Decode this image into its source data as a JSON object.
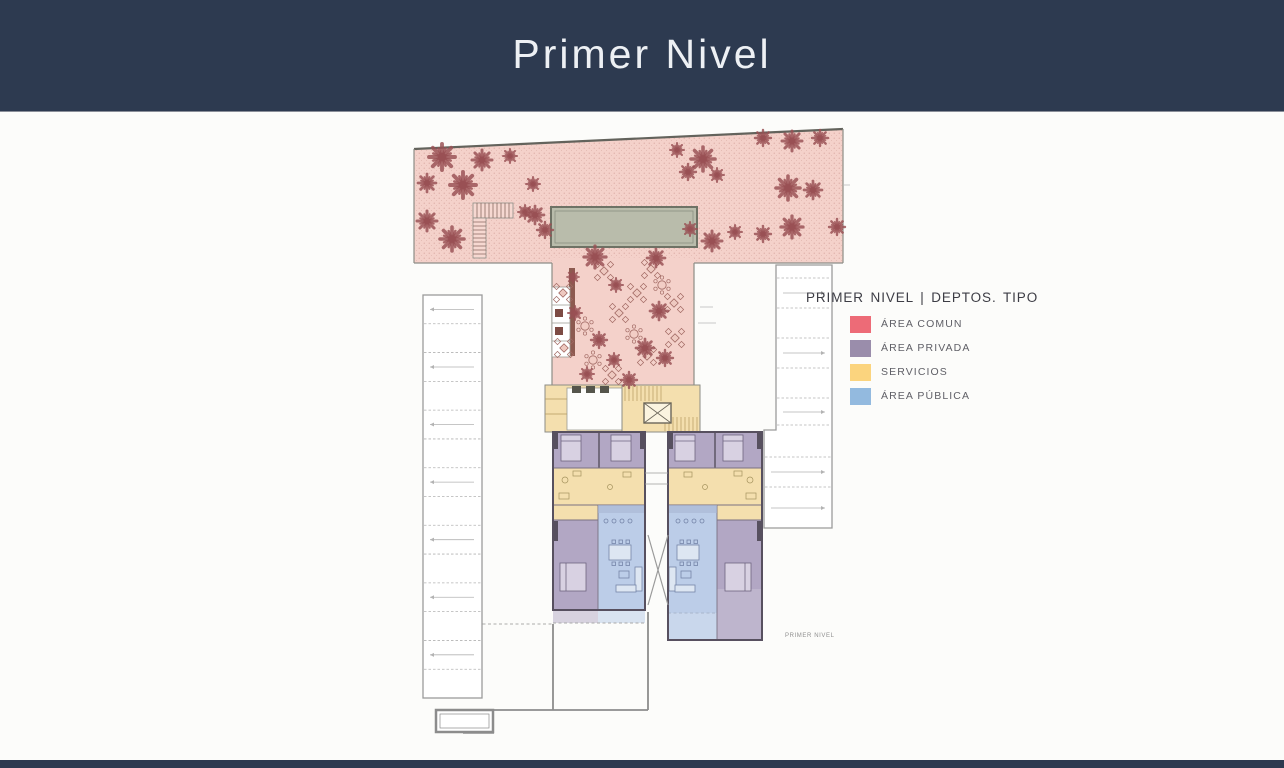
{
  "header": {
    "title": "Primer Nivel"
  },
  "theme": {
    "header_bg": "#2d3a50",
    "title_color": "#edf0f4",
    "slide_bg": "#fcfcfa",
    "footer_bg": "#2d3a50"
  },
  "legend": {
    "title": "PRIMER NIVEL | DEPTOS. TIPO",
    "items": [
      {
        "name": "area-comun",
        "label": "ÁREA COMUN",
        "color": "#ed6b77"
      },
      {
        "name": "area-privada",
        "label": "ÁREA PRIVADA",
        "color": "#9a8dab"
      },
      {
        "name": "servicios",
        "label": "SERVICIOS",
        "color": "#fbd47e"
      },
      {
        "name": "area-publica",
        "label": "ÁREA PÚBLICA",
        "color": "#93badf"
      }
    ]
  },
  "plan": {
    "caption": "PRIMER NIVEL",
    "colors": {
      "garden": "#f4d1ca",
      "pool": "#b9bcab",
      "services": "#f4dfae",
      "private": "#b2a7c4",
      "public": "#bccde8",
      "wall": "#57505f",
      "tree": "#995054",
      "table": "#a26a64",
      "parking_line": "#b3b3b3",
      "parking_border": "#9b9b9b"
    },
    "garden_trees": [
      [
        29,
        30,
        13
      ],
      [
        69,
        33,
        10
      ],
      [
        97,
        29,
        7
      ],
      [
        14,
        56,
        9
      ],
      [
        50,
        58,
        13
      ],
      [
        14,
        94,
        10
      ],
      [
        39,
        112,
        12
      ],
      [
        120,
        57,
        7
      ],
      [
        122,
        88,
        9
      ],
      [
        112,
        85,
        7
      ],
      [
        132,
        103,
        8
      ],
      [
        264,
        23,
        7
      ],
      [
        290,
        32,
        12
      ],
      [
        275,
        45,
        8
      ],
      [
        304,
        48,
        7
      ],
      [
        350,
        11,
        8
      ],
      [
        379,
        14,
        10
      ],
      [
        407,
        11,
        8
      ],
      [
        375,
        61,
        12
      ],
      [
        400,
        63,
        9
      ],
      [
        424,
        100,
        8
      ],
      [
        379,
        100,
        11
      ],
      [
        350,
        107,
        8
      ],
      [
        322,
        105,
        7
      ],
      [
        299,
        114,
        10
      ],
      [
        277,
        102,
        7
      ]
    ],
    "terrace_trees": [
      [
        182,
        130,
        11
      ],
      [
        243,
        131,
        9
      ],
      [
        203,
        158,
        7
      ],
      [
        160,
        150,
        6
      ],
      [
        246,
        184,
        9
      ],
      [
        162,
        186,
        7
      ],
      [
        186,
        213,
        8
      ],
      [
        232,
        221,
        9
      ],
      [
        201,
        233,
        7
      ],
      [
        252,
        231,
        8
      ],
      [
        174,
        247,
        7
      ],
      [
        216,
        253,
        8
      ]
    ],
    "tables_x": [
      [
        150,
        166
      ],
      [
        191,
        144
      ],
      [
        238,
        142
      ],
      [
        261,
        176
      ],
      [
        206,
        186
      ],
      [
        151,
        221
      ],
      [
        234,
        229
      ],
      [
        199,
        248
      ],
      [
        262,
        211
      ],
      [
        224,
        166
      ]
    ],
    "tables_round": [
      [
        172,
        199
      ],
      [
        249,
        158
      ],
      [
        221,
        207
      ],
      [
        180,
        233
      ]
    ],
    "parking_left": {
      "x": 10,
      "y": 168,
      "w": 59,
      "h": 403,
      "rows": 14
    },
    "parking_right": {
      "x_top": 363,
      "x_bottom": 351,
      "x2": 419,
      "y": 138,
      "bottom": 401,
      "split": 303,
      "row_lines": [
        151,
        181,
        211,
        241,
        271,
        298,
        330,
        360
      ],
      "arrow_rows": [
        166,
        226,
        285,
        345,
        381
      ]
    }
  }
}
